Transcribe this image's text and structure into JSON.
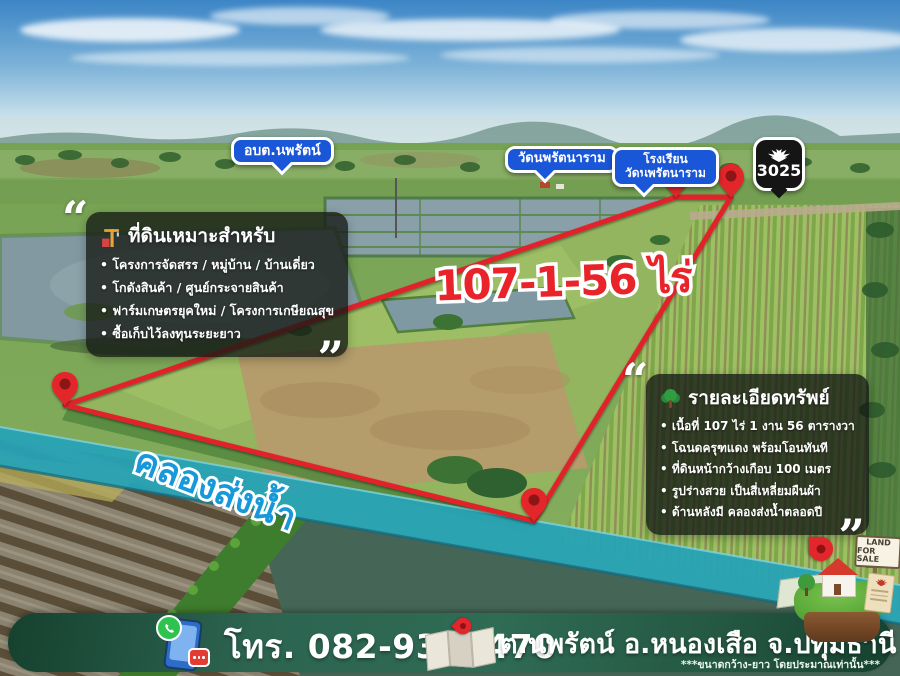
{
  "map_labels": {
    "obt": "อบต.นพรัตน์",
    "temple": "วัดนพรัตนาราม",
    "school_line1": "โรงเรียน",
    "school_line2": "วัดนพรัตนาราม"
  },
  "route_shield": {
    "number": "3025"
  },
  "plot": {
    "area_text": "107-1-56 ไร่"
  },
  "canal": {
    "label": "คลองส่งน้ำ"
  },
  "quotes": {
    "open": "“",
    "close": "”"
  },
  "left_box": {
    "title": "ที่ดินเหมาะสำหรับ",
    "items": [
      "โครงการจัดสรร / หมู่บ้าน / บ้านเดี่ยว",
      "โกดังสินค้า / ศูนย์กระจายสินค้า",
      "ฟาร์มเกษตรยุคใหม่ / โครงการเกษียณสุข",
      "ซื้อเก็บไว้ลงทุนระยะยาว"
    ]
  },
  "right_box": {
    "title": "รายละเอียดทรัพย์",
    "items": [
      "เนื้อที่ 107 ไร่ 1 งาน 56 ตารางวา",
      "โฉนดครุฑแดง พร้อมโอนทันที",
      "ที่ดินหน้ากว้างเกือบ 100 เมตร",
      "รูปร่างสวย เป็นสี่เหลี่ยมผืนผ้า",
      "ด้านหลังมี คลองส่งน้ำตลอดปี"
    ]
  },
  "footer": {
    "phone": "โทร. 082-9385470",
    "location": "ต.นพรัตน์ อ.หนองเสือ จ.ปทุมธานี",
    "disclaimer": "***ขนาดกว้าง-ยาว โดยประมาณเท่านั้น***"
  },
  "sale_sign": {
    "line1": "LAND",
    "line2": "FOR SALE"
  },
  "icons": {
    "left_box_icon": "crane-icon",
    "right_box_icon": "tree-icon",
    "shield_icon": "garuda-icon",
    "corner_markers": "map-pin-icon"
  },
  "colors": {
    "boundary_red": "#e2242b",
    "label_blue": "#1956d8",
    "canal_teal": "#27a2b5",
    "canal_text_blue": "#1798d8",
    "footer_green": "#2c6450",
    "area_text_red": "#e8242a"
  }
}
